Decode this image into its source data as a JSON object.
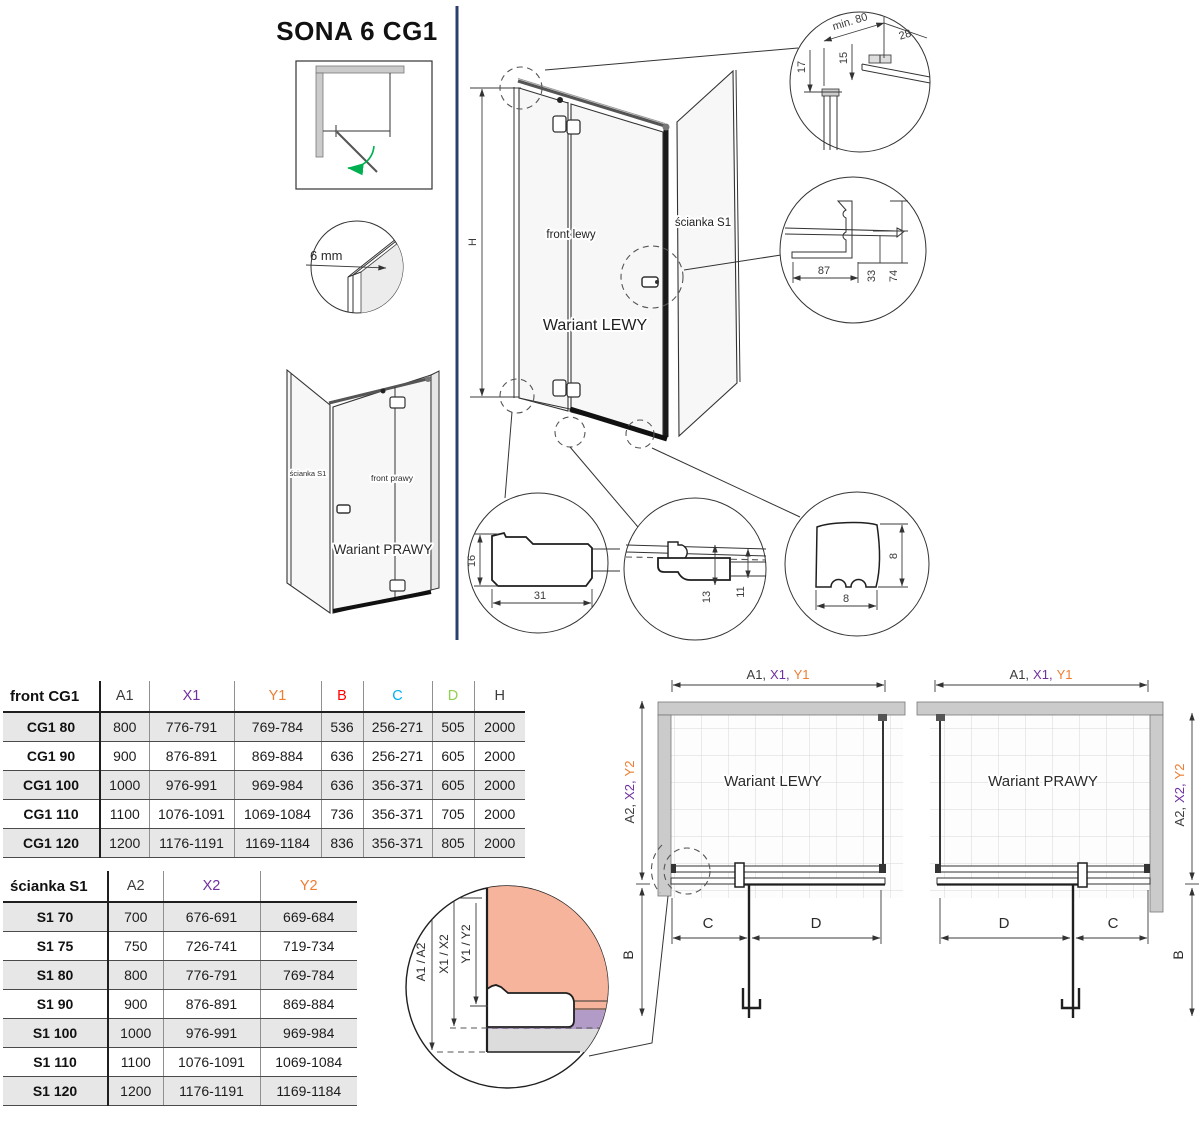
{
  "title": "SONA 6 CG1",
  "labels": {
    "glass_thickness": "6 mm",
    "height_dim": "H",
    "front_left": "front lewy",
    "front_right": "front prawy",
    "side_panel": "ścianka S1",
    "variant_left": "Wariant LEWY",
    "variant_right": "Wariant PRAWY"
  },
  "details": {
    "top_min": "min. 80",
    "top_28": "28",
    "top_15": "15",
    "top_17": "17",
    "handle_87": "87",
    "handle_33": "33",
    "handle_74": "74",
    "profile_16": "16",
    "profile_31": "31",
    "seal_13": "13",
    "seal_11": "11",
    "gasket_h": "8",
    "gasket_w": "8"
  },
  "plans": {
    "top_dim": [
      "A1,",
      "X1,",
      "Y1"
    ],
    "side_dim": [
      "A2,",
      "X2,",
      "Y2"
    ],
    "c": "C",
    "d": "D",
    "b": "B",
    "left_title": "Wariant LEWY",
    "right_title": "Wariant PRAWY"
  },
  "legend": {
    "a": "A1 / A2",
    "x": "X1 / X2",
    "y": "Y1 / Y2",
    "b": "B"
  },
  "colors": {
    "purple": "#7030A0",
    "orange": "#ED7D31",
    "red": "#FF0000",
    "cyan": "#00B0F0",
    "green": "#92D050",
    "dark": "#3B3B3B",
    "slate": "#44546A",
    "navy_separator": "#2C3E70",
    "salmon": "#F5B49B",
    "violet_band": "#B39BC8",
    "gray_band": "#DCDCDC"
  },
  "tables": {
    "front": {
      "title": "front CG1",
      "columns": [
        {
          "label": "A1",
          "color": "#3B3B3B"
        },
        {
          "label": "X1",
          "color": "#7030A0"
        },
        {
          "label": "Y1",
          "color": "#ED7D31"
        },
        {
          "label": "B",
          "color": "#FF0000"
        },
        {
          "label": "C",
          "color": "#00B0F0"
        },
        {
          "label": "D",
          "color": "#92D050"
        },
        {
          "label": "H",
          "color": "#3B3B3B"
        }
      ],
      "rows": [
        [
          "CG1 80",
          "800",
          "776-791",
          "769-784",
          "536",
          "256-271",
          "505",
          "2000"
        ],
        [
          "CG1 90",
          "900",
          "876-891",
          "869-884",
          "636",
          "256-271",
          "605",
          "2000"
        ],
        [
          "CG1 100",
          "1000",
          "976-991",
          "969-984",
          "636",
          "356-371",
          "605",
          "2000"
        ],
        [
          "CG1 110",
          "1100",
          "1076-1091",
          "1069-1084",
          "736",
          "356-371",
          "705",
          "2000"
        ],
        [
          "CG1 120",
          "1200",
          "1176-1191",
          "1169-1184",
          "836",
          "356-371",
          "805",
          "2000"
        ]
      ]
    },
    "side": {
      "title": "ścianka S1",
      "columns": [
        {
          "label": "A2",
          "color": "#3B3B3B"
        },
        {
          "label": "X2",
          "color": "#7030A0"
        },
        {
          "label": "Y2",
          "color": "#ED7D31"
        }
      ],
      "rows": [
        [
          "S1 70",
          "700",
          "676-691",
          "669-684"
        ],
        [
          "S1 75",
          "750",
          "726-741",
          "719-734"
        ],
        [
          "S1 80",
          "800",
          "776-791",
          "769-784"
        ],
        [
          "S1 90",
          "900",
          "876-891",
          "869-884"
        ],
        [
          "S1 100",
          "1000",
          "976-991",
          "969-984"
        ],
        [
          "S1 110",
          "1100",
          "1076-1091",
          "1069-1084"
        ],
        [
          "S1 120",
          "1200",
          "1176-1191",
          "1169-1184"
        ]
      ]
    }
  }
}
